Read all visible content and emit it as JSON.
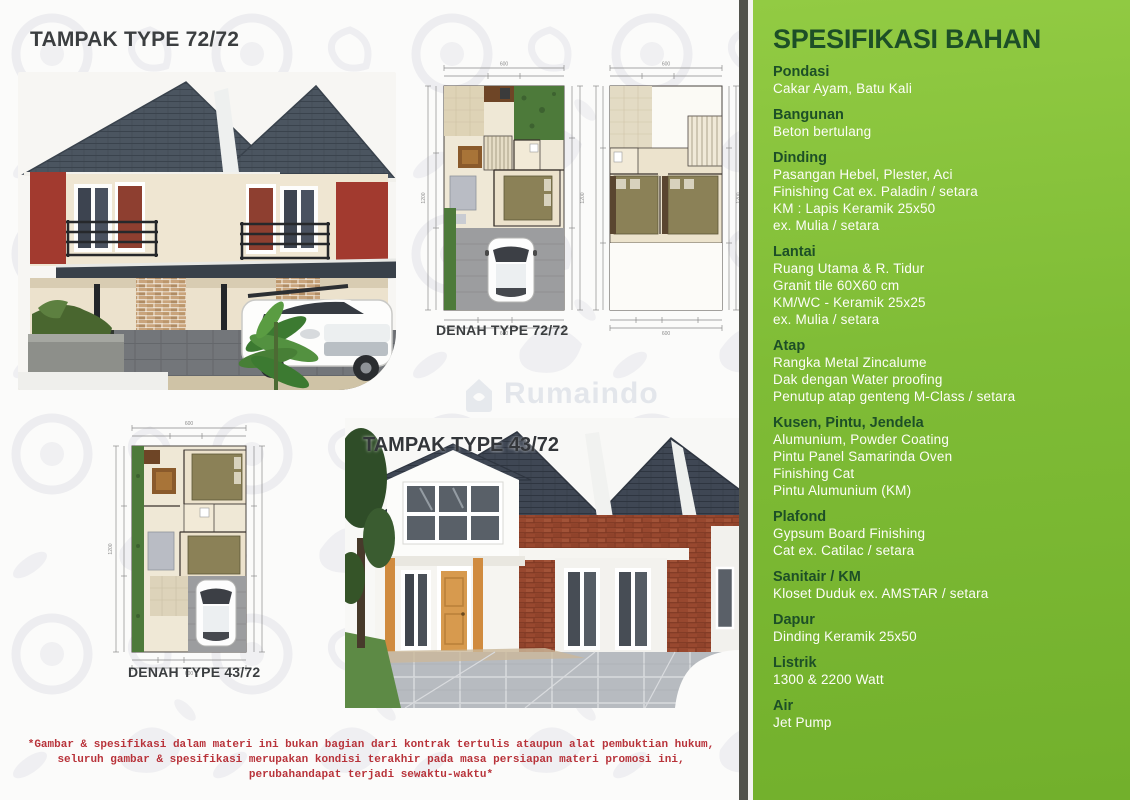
{
  "left": {
    "tampak72_title": "TAMPAK TYPE 72/72",
    "denah72_label": "DENAH TYPE 72/72",
    "tampak43_title": "TAMPAK TYPE 43/72",
    "denah43_label": "DENAH TYPE 43/72",
    "watermark": "Rumaindo"
  },
  "plans": {
    "lot_width": "600",
    "lot_height": "1200"
  },
  "disclaimer": {
    "lines": [
      "*Gambar & spesifikasi dalam materi ini bukan bagian dari kontrak tertulis ataupun alat pembuktian hukum,",
      "seluruh gambar & spesifikasi merupakan kondisi terakhir pada masa persiapan materi promosi ini,",
      "perubahandapat terjadi sewaktu-waktu*"
    ]
  },
  "specs": {
    "title": "SPESIFIKASI BAHAN",
    "sections": [
      {
        "heading": "Pondasi",
        "lines": [
          "Cakar Ayam, Batu Kali"
        ]
      },
      {
        "heading": "Bangunan",
        "lines": [
          "Beton bertulang"
        ]
      },
      {
        "heading": "Dinding",
        "lines": [
          "Pasangan Hebel, Plester, Aci",
          "Finishing Cat ex. Paladin / setara",
          "KM : Lapis Keramik 25x50",
          "ex. Mulia / setara"
        ]
      },
      {
        "heading": "Lantai",
        "lines": [
          "Ruang Utama & R. Tidur",
          "Granit tile 60X60 cm",
          "KM/WC - Keramik 25x25",
          "ex. Mulia / setara"
        ]
      },
      {
        "heading": "Atap",
        "lines": [
          "Rangka Metal Zincalume",
          "Dak dengan Water proofing",
          "Penutup atap genteng M-Class / setara"
        ]
      },
      {
        "heading": "Kusen, Pintu, Jendela",
        "lines": [
          "Alumunium, Powder Coating",
          "Pintu Panel Samarinda Oven",
          "Finishing Cat",
          "Pintu Alumunium (KM)"
        ]
      },
      {
        "heading": "Plafond",
        "lines": [
          "Gypsum Board Finishing",
          "Cat ex. Catilac / setara"
        ]
      },
      {
        "heading": "Sanitair / KM",
        "lines": [
          "Kloset Duduk ex. AMSTAR / setara"
        ]
      },
      {
        "heading": "Dapur",
        "lines": [
          "Dinding Keramik 25x50"
        ]
      },
      {
        "heading": "Listrik",
        "lines": [
          "1300 & 2200 Watt"
        ]
      },
      {
        "heading": "Air",
        "lines": [
          "Jet Pump"
        ]
      }
    ]
  },
  "colors": {
    "green_top": "#92cb43",
    "green_bottom": "#72b02c",
    "spec_heading_green": "#1d4f27",
    "divider_dark": "#52534d",
    "disclaimer_red": "#b8333a",
    "headline_dark": "#3b3e40"
  }
}
